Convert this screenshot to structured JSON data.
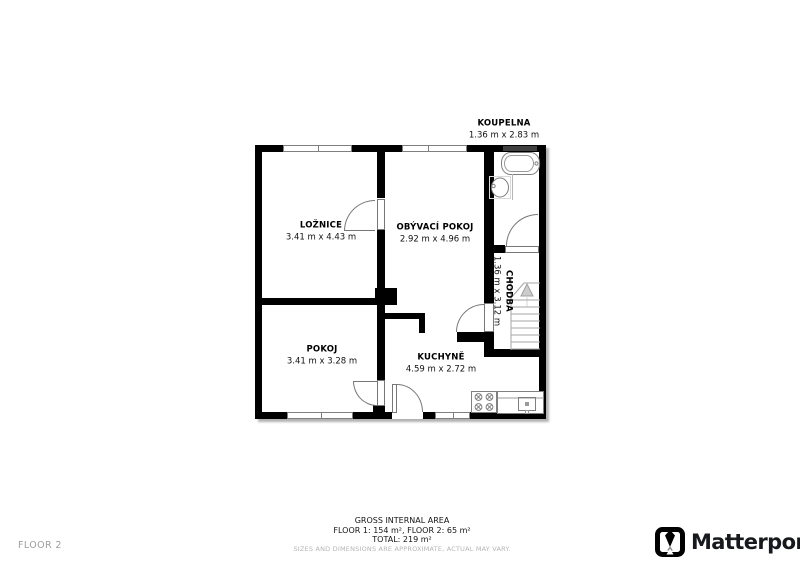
{
  "floor_label": "FLOOR 2",
  "rooms": [
    {
      "id": "koupelna",
      "name": "KOUPELNA",
      "dims": "1.36 m x 2.83 m"
    },
    {
      "id": "loznice",
      "name": "LOŽNICE",
      "dims": "3.41 m x 4.43 m"
    },
    {
      "id": "obyvaci",
      "name": "OBÝVACÍ POKOJ",
      "dims": "2.92 m x 4.96 m"
    },
    {
      "id": "chodba",
      "name": "CHODBA",
      "dims": "1.36 m x 3.12 m"
    },
    {
      "id": "pokoj",
      "name": "POKOJ",
      "dims": "3.41 m x 3.28 m"
    },
    {
      "id": "kuchyne",
      "name": "KUCHYNĚ",
      "dims": "4.59 m x 2.72 m"
    }
  ],
  "footer": {
    "line1": "GROSS INTERNAL AREA",
    "line2": "FLOOR 1: 154 m², FLOOR 2: 65 m²",
    "line3": "TOTAL: 219 m²",
    "disclaimer": "SIZES AND DIMENSIONS ARE APPROXIMATE, ACTUAL MAY VARY."
  },
  "brand": {
    "name": "Matterport"
  },
  "icons": {
    "bathtub": "bathtub-icon",
    "basin": "sink-icon",
    "stove": "stove-icon",
    "counter": "kitchen-counter-sink-icon",
    "stairs": "stairs-up-icon",
    "logo": "matterport-logo-icon"
  },
  "colors": {
    "wall": "#000000",
    "fixture_outline": "#7f7f7f",
    "muted_text": "#9e9e9e",
    "brand_text": "#17191d"
  }
}
